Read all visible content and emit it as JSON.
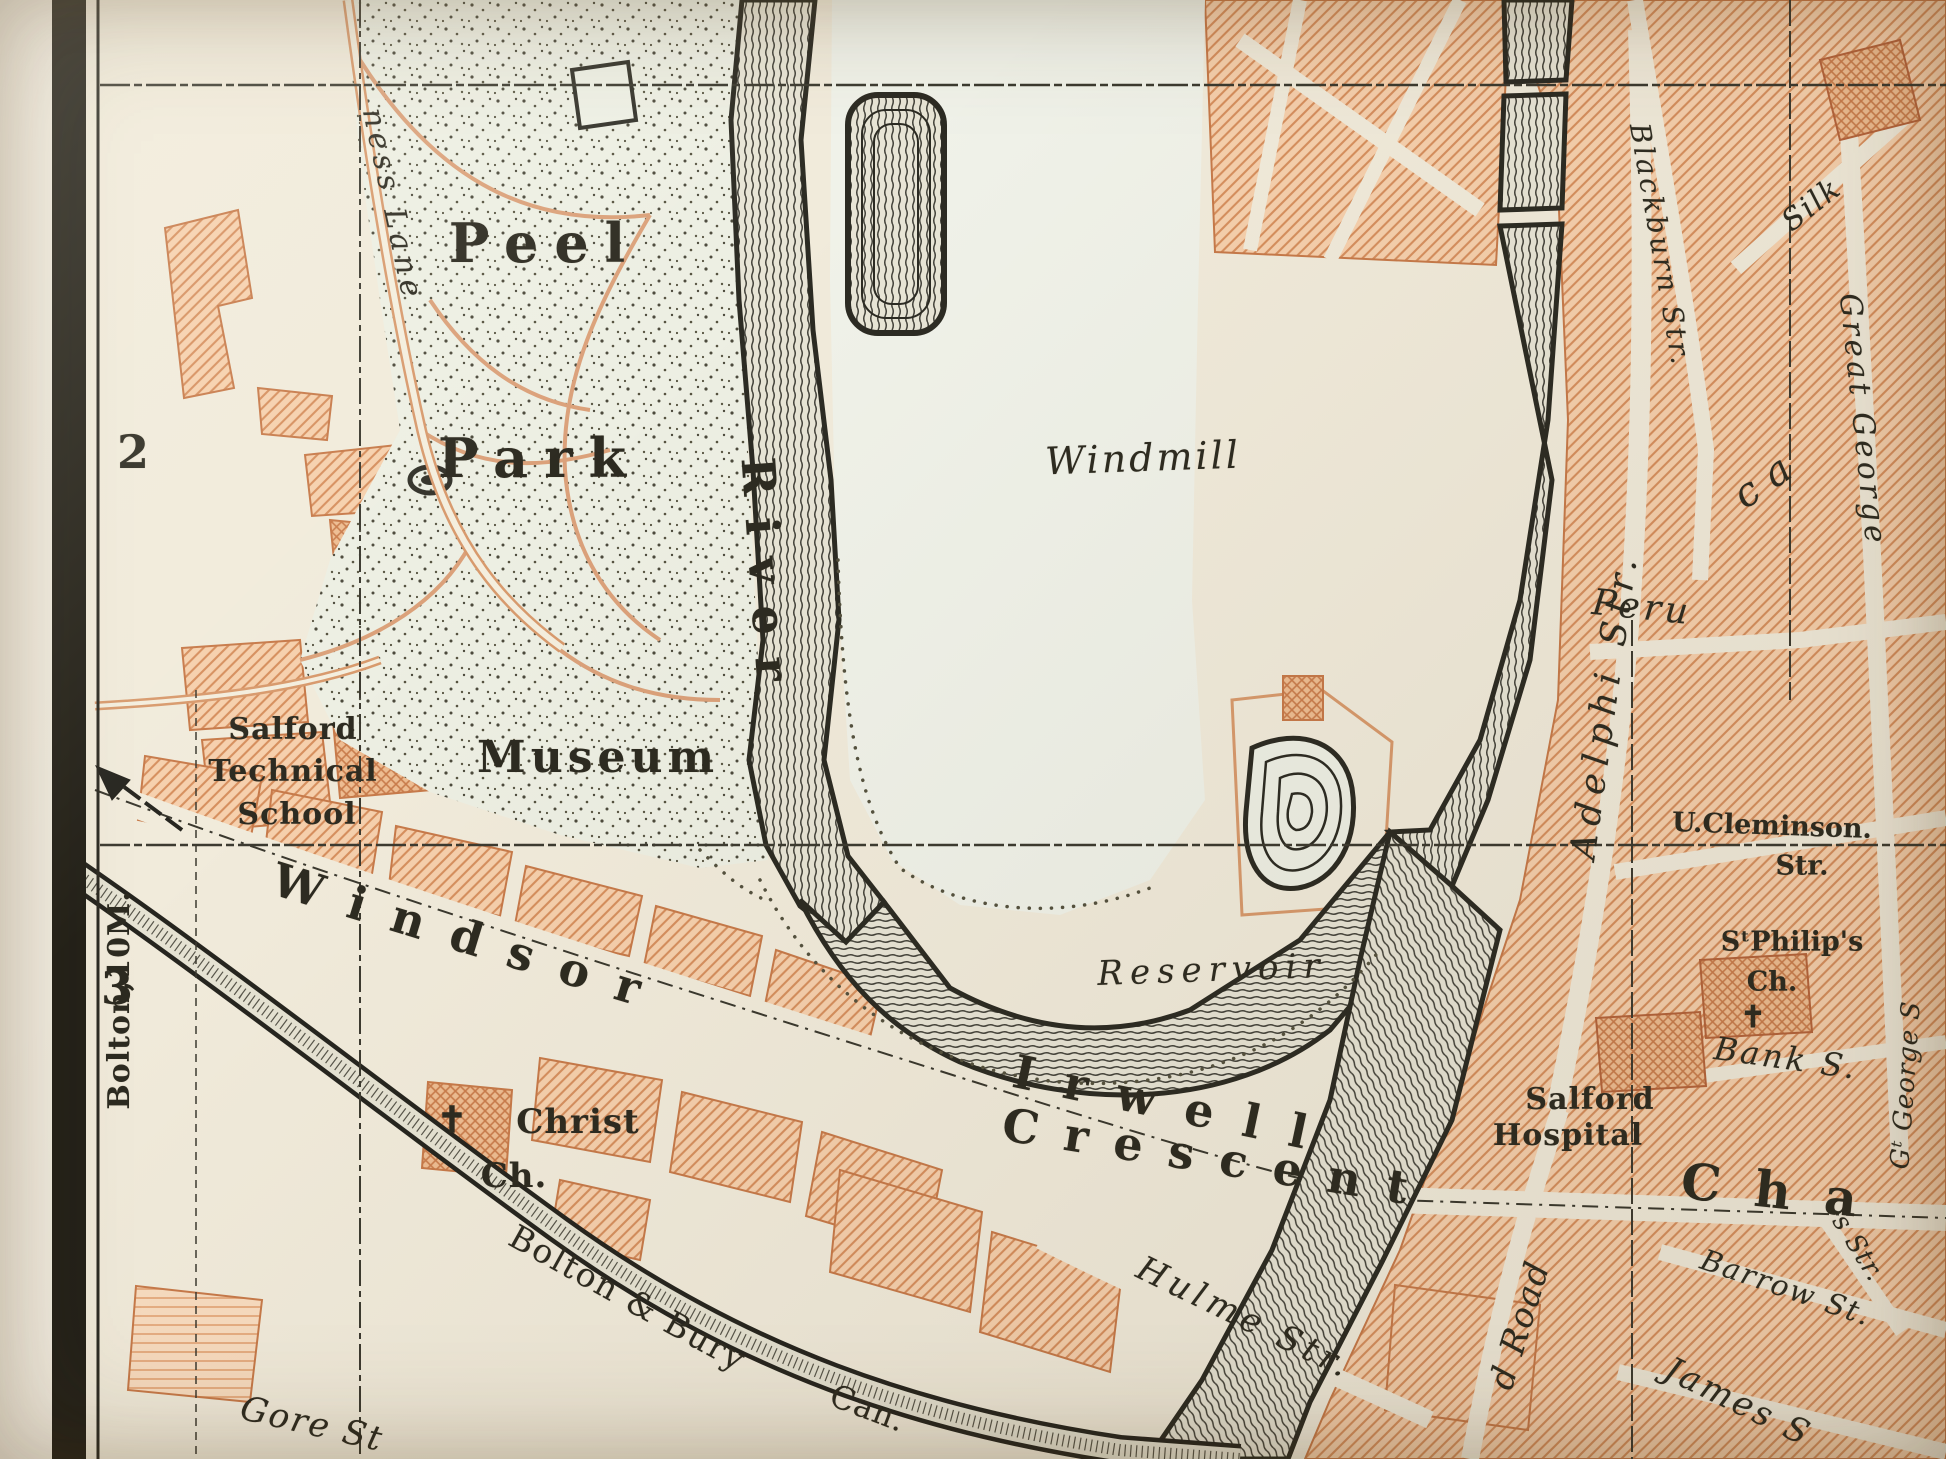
{
  "map": {
    "kind": "vintage-engraved-city-map",
    "grid_row_labels": [
      "2",
      "3"
    ],
    "margin_note": "Bolton,10M.",
    "colors": {
      "paper": "#f1ebdb",
      "park_tint": "#edefe3",
      "meadow_tint": "#f0f2e9",
      "building_fill": "#f6d0ad",
      "building_hatch": "#d68f5e",
      "building_dark": "#eebd92",
      "river_ink": "#2c2b23",
      "text_ink": "#2d2b21",
      "road_orange": "#d89a6d"
    },
    "labels": [
      {
        "name": "label-peel",
        "text": "Peel",
        "x": 545,
        "y": 243,
        "rot": 0,
        "size": 54,
        "ls": 16,
        "cls": "b"
      },
      {
        "name": "label-park",
        "text": "Park",
        "x": 540,
        "y": 458,
        "rot": 0,
        "size": 54,
        "ls": 16,
        "cls": "b"
      },
      {
        "name": "label-museum",
        "text": "Museum",
        "x": 598,
        "y": 758,
        "rot": 0,
        "size": 44,
        "ls": 5,
        "cls": "b"
      },
      {
        "name": "label-salford-technical-1",
        "text": "Salford",
        "x": 293,
        "y": 730,
        "rot": 0,
        "size": 30,
        "ls": 1,
        "cls": "b"
      },
      {
        "name": "label-salford-technical-2",
        "text": "Technical",
        "x": 293,
        "y": 772,
        "rot": 0,
        "size": 30,
        "ls": 1,
        "cls": "b"
      },
      {
        "name": "label-salford-technical-3",
        "text": "School",
        "x": 297,
        "y": 815,
        "rot": 0,
        "size": 30,
        "ls": 1,
        "cls": "b"
      },
      {
        "name": "label-windmill",
        "text": "Windmill",
        "x": 1143,
        "y": 458,
        "rot": -2,
        "size": 38,
        "ls": 3,
        "cls": "i"
      },
      {
        "name": "label-reservoir",
        "text": "Reservoir",
        "x": 1212,
        "y": 970,
        "rot": -2,
        "size": 34,
        "ls": 7,
        "cls": "i"
      },
      {
        "name": "label-river",
        "text": "River",
        "x": 766,
        "y": 580,
        "rot": 86,
        "size": 46,
        "ls": 22,
        "cls": "b"
      },
      {
        "name": "label-irwell",
        "text": "Irwell",
        "x": 1175,
        "y": 1105,
        "rot": 12,
        "size": 46,
        "ls": 30,
        "cls": "b"
      },
      {
        "name": "label-windsor",
        "text": "Windsor",
        "x": 470,
        "y": 938,
        "rot": 17,
        "size": 46,
        "ls": 28,
        "cls": "b"
      },
      {
        "name": "label-crescent",
        "text": "Crescent",
        "x": 1218,
        "y": 1158,
        "rot": 9,
        "size": 46,
        "ls": 26,
        "cls": "b"
      },
      {
        "name": "label-chapel-cha",
        "text": "Cha",
        "x": 1786,
        "y": 1192,
        "rot": 6,
        "size": 50,
        "ls": 34,
        "cls": "b"
      },
      {
        "name": "label-christ-church-1",
        "text": "Christ",
        "x": 578,
        "y": 1122,
        "rot": 0,
        "size": 34,
        "ls": 1,
        "cls": "b"
      },
      {
        "name": "label-christ-church-2",
        "text": "Ch.",
        "x": 514,
        "y": 1176,
        "rot": 0,
        "size": 34,
        "ls": 1,
        "cls": "b"
      },
      {
        "name": "christ-church-cross-icon",
        "text": "✝",
        "x": 452,
        "y": 1120,
        "rot": 0,
        "size": 36,
        "ls": 0,
        "cls": "b"
      },
      {
        "name": "label-bolton-bury-canal",
        "text": "Bolton & Bury",
        "x": 628,
        "y": 1298,
        "rot": 29,
        "size": 33,
        "ls": 2,
        "cls": ""
      },
      {
        "name": "label-canal-can",
        "text": "Can.",
        "x": 868,
        "y": 1408,
        "rot": 21,
        "size": 32,
        "ls": 1,
        "cls": ""
      },
      {
        "name": "label-gore-street",
        "text": "Gore St",
        "x": 312,
        "y": 1424,
        "rot": 13,
        "size": 34,
        "ls": 2,
        "cls": "i"
      },
      {
        "name": "label-hulme-street",
        "text": "Hulme Str.",
        "x": 1245,
        "y": 1318,
        "rot": 26,
        "size": 34,
        "ls": 5,
        "cls": "i"
      },
      {
        "name": "label-oldfield-road",
        "text": "d Road",
        "x": 1520,
        "y": 1325,
        "rot": -73,
        "size": 34,
        "ls": 2,
        "cls": "i"
      },
      {
        "name": "label-james-street",
        "text": "James S",
        "x": 1738,
        "y": 1402,
        "rot": 26,
        "size": 34,
        "ls": 3,
        "cls": "i"
      },
      {
        "name": "label-barrow-street",
        "text": "Barrow St.",
        "x": 1786,
        "y": 1288,
        "rot": 19,
        "size": 29,
        "ls": 2,
        "cls": "i"
      },
      {
        "name": "label-s-street-fragment",
        "text": "s Str.",
        "x": 1858,
        "y": 1248,
        "rot": 58,
        "size": 26,
        "ls": 1,
        "cls": "i"
      },
      {
        "name": "label-g-george-street",
        "text": "Gᵗ George S",
        "x": 1906,
        "y": 1085,
        "rot": -86,
        "size": 26,
        "ls": 1,
        "cls": "i"
      },
      {
        "name": "label-great-george-street",
        "text": "Great George",
        "x": 1862,
        "y": 420,
        "rot": 84,
        "size": 30,
        "ls": 4,
        "cls": "i"
      },
      {
        "name": "label-silk-street",
        "text": "Silk",
        "x": 1812,
        "y": 205,
        "rot": -38,
        "size": 30,
        "ls": 2,
        "cls": "i"
      },
      {
        "name": "label-blackburn-street",
        "text": "Blackburn Str.",
        "x": 1660,
        "y": 245,
        "rot": 80,
        "size": 28,
        "ls": 3,
        "cls": "i"
      },
      {
        "name": "label-adelphi-street",
        "text": "Adelphi Str.",
        "x": 1605,
        "y": 705,
        "rot": -82,
        "size": 36,
        "ls": 8,
        "cls": "i"
      },
      {
        "name": "label-peru-street",
        "text": "Peru",
        "x": 1642,
        "y": 608,
        "rot": 6,
        "size": 36,
        "ls": 4,
        "cls": "i"
      },
      {
        "name": "label-ca-fragment",
        "text": "ca",
        "x": 1768,
        "y": 478,
        "rot": -35,
        "size": 40,
        "ls": 14,
        "cls": "i"
      },
      {
        "name": "label-cleminson-1",
        "text": "U.Cleminson.",
        "x": 1772,
        "y": 826,
        "rot": 2,
        "size": 27,
        "ls": 0,
        "cls": "b"
      },
      {
        "name": "label-cleminson-2",
        "text": "Str.",
        "x": 1802,
        "y": 866,
        "rot": 0,
        "size": 27,
        "ls": 0,
        "cls": "b"
      },
      {
        "name": "label-st-philips-1",
        "text": "SᵗPhilip's",
        "x": 1792,
        "y": 942,
        "rot": 0,
        "size": 27,
        "ls": 0,
        "cls": "b"
      },
      {
        "name": "label-st-philips-2",
        "text": "Ch.",
        "x": 1772,
        "y": 982,
        "rot": 0,
        "size": 27,
        "ls": 0,
        "cls": "b"
      },
      {
        "name": "st-philips-cross-icon",
        "text": "✝",
        "x": 1753,
        "y": 1018,
        "rot": 0,
        "size": 30,
        "ls": 0,
        "cls": "b"
      },
      {
        "name": "label-bank-street",
        "text": "Bank S.",
        "x": 1786,
        "y": 1058,
        "rot": 8,
        "size": 32,
        "ls": 3,
        "cls": "i"
      },
      {
        "name": "label-salford-hospital-1",
        "text": "Salford",
        "x": 1590,
        "y": 1100,
        "rot": 0,
        "size": 30,
        "ls": 1,
        "cls": "b"
      },
      {
        "name": "label-salford-hospital-2",
        "text": "Hospital",
        "x": 1568,
        "y": 1136,
        "rot": 0,
        "size": 30,
        "ls": 1,
        "cls": "b"
      },
      {
        "name": "label-ness-lane",
        "text": "ness Lane",
        "x": 392,
        "y": 205,
        "rot": 78,
        "size": 30,
        "ls": 5,
        "cls": "i"
      },
      {
        "name": "label-bolton-10m",
        "text": "Bolton,10M.",
        "x": 120,
        "y": 1000,
        "rot": -90,
        "size": 30,
        "ls": 1,
        "cls": "b cond"
      },
      {
        "name": "grid-number-2",
        "text": "2",
        "x": 133,
        "y": 452,
        "rot": 0,
        "size": 46,
        "ls": 0,
        "cls": "b"
      },
      {
        "name": "grid-number-3",
        "text": "3",
        "x": 117,
        "y": 988,
        "rot": 0,
        "size": 46,
        "ls": 0,
        "cls": "b"
      }
    ]
  }
}
